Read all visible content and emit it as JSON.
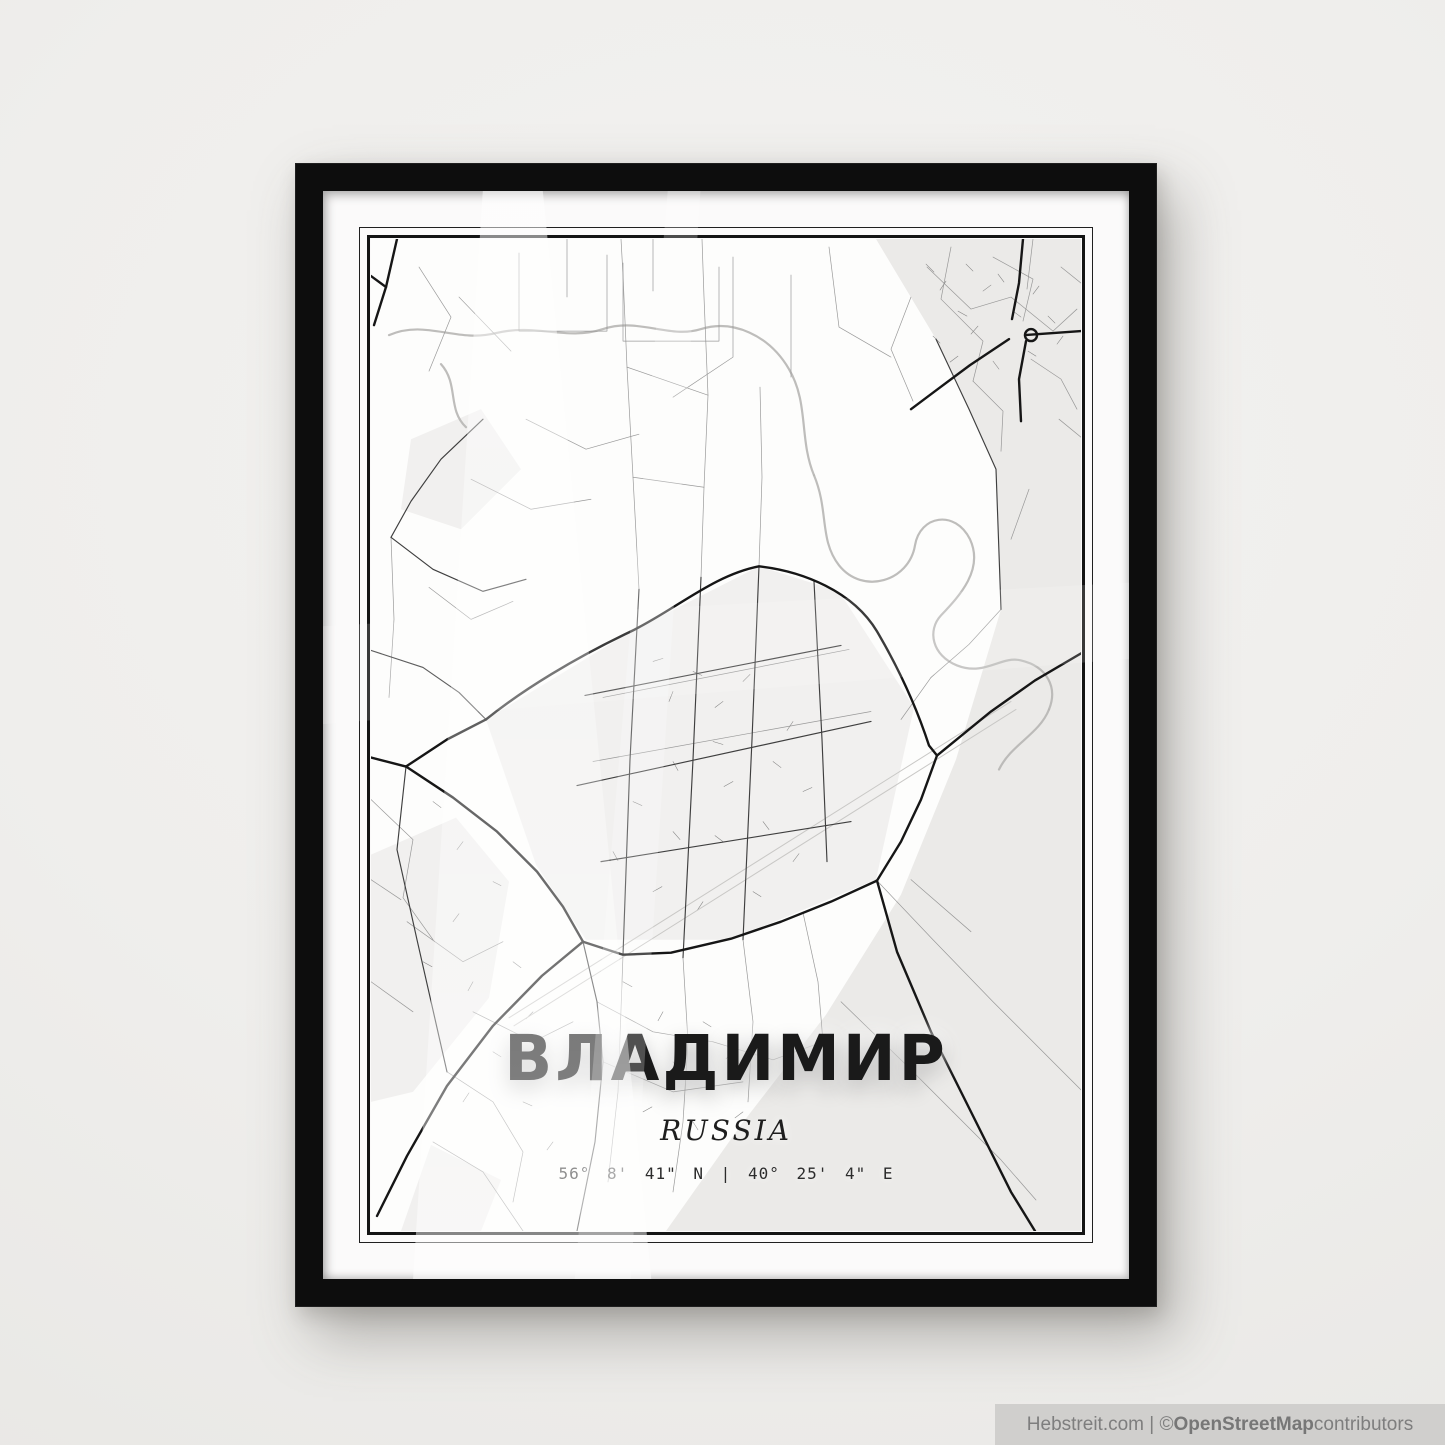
{
  "scene": {
    "wall_color": "#efeeec",
    "frame_color": "#0d0d0d",
    "mat_color": "#fbfafa",
    "map_background": "#fdfdfc"
  },
  "poster": {
    "title": "ВЛАДИМИР",
    "subtitle": "RUSSIA",
    "coordinates": "56° 8' 41\" N | 40° 25' 4\" E"
  },
  "watermark": {
    "prefix": "Hebstreit.com | © ",
    "brand": "OpenStreetMap",
    "suffix": " contributors"
  },
  "map": {
    "viewBox": "0 0 710 991",
    "layers": [
      {
        "name": "tinted-areas",
        "fill": "#ebeae8",
        "paths": [
          "M505,0 L710,0 L710,991 L295,991 L370,885 L455,775 L530,655 L585,520 L630,370 L625,230 L565,100 Z"
        ]
      },
      {
        "name": "tinted-areas-light",
        "fill": "#f1f0ef",
        "paths": [
          "M115,480 L260,392 L388,327 L468,352 L543,468 L505,640 L360,700 L215,700 L165,625 Z",
          "M0,615 L85,578 L138,642 L118,758 L42,852 L0,862 Z",
          "M60,905 L130,940 L110,991 L30,991 Z",
          "M40,200 L110,170 L150,230 L90,290 L30,270 Z"
        ]
      },
      {
        "name": "hatch-texture",
        "stroke": "#6f6f6f",
        "width": 0.55,
        "opacity": 0.85,
        "paths": [
          "M555,25 l8,8 M575,42 l-6,9 M595,25 l7,7 M612,52 l8,-6 M627,35 l6,8 M587,72 l9,5 M607,87 l-7,8 M642,72 l8,6 M662,55 l6,-8 M677,77 l7,7 M692,97 l-6,8 M657,112 l8,5 M622,122 l6,8 M587,117 l-8,6 M562,97 l7,7",
          "M282,422 l10,-3 M302,452 l-4,10 M322,432 l9,4 M352,462 l-8,6 M372,442 l7,-7 M342,502 l10,3 M302,522 l5,9 M362,542 l-9,5 M402,522 l8,6 M422,482 l-6,9 M432,552 l9,-4 M392,582 l6,8 M352,602 l-8,-6 M302,592 l7,8 M262,562 l9,4 M242,612 l5,9 M282,652 l9,-5 M332,662 l-6,9 M382,652 l8,5 M422,622 l6,-8",
          "M62,562 l8,6 M92,602 l-6,8 M122,642 l8,4 M82,682 l6,-8 M52,722 l9,5 M102,742 l-5,9 M142,722 l8,6 M162,772 l-7,7 M122,812 l8,5 M92,862 l6,-9 M152,862 l9,4 M182,902 l-6,8",
          "M252,742 l9,5 M292,772 l-5,9 M332,782 l8,5 M362,812 l-7,7 M302,822 l6,9 M272,872 l9,-5 M322,882 l5,8 M372,872 l-8,6"
        ]
      },
      {
        "name": "water",
        "stroke": "#b7b6b4",
        "width": 2.2,
        "opacity": 0.9,
        "paths": [
          "M18,96 C55,80 85,104 125,94 C165,84 195,102 232,90 C268,78 298,100 330,90 C362,80 398,96 418,130 C438,164 428,200 443,236",
          "M443,236 C458,272 448,300 468,326 C492,356 538,342 544,306 C549,276 584,270 599,300 C613,330 589,356 570,376 C556,391 561,416 586,426 C614,437 630,416 650,421 C676,427 687,448 678,470",
          "M678,470 C668,495 640,505 628,530",
          "M70,125 C88,145 76,170 95,188"
        ]
      },
      {
        "name": "railway",
        "stroke": "#c9c8c6",
        "width": 1,
        "paths": [
          "M138,778 L640,462",
          "M143,786 L645,470"
        ]
      },
      {
        "name": "roads-minor",
        "stroke": "#8f8f8f",
        "width": 0.7,
        "opacity": 0.9,
        "paths": [
          "M148,14 L148,92 L236,92 L236,16",
          "M252,24 L252,102 L348,102 L348,28",
          "M196,0 L196,58",
          "M282,0 L282,52",
          "M88,58 L140,112",
          "M48,28 L80,78 L58,132",
          "M362,18 L362,118 L302,158",
          "M420,36 L420,138",
          "M458,8 L468,88 L520,118",
          "M268,350 L262,238 L256,128 L252,36 L250,0",
          "M330,338 L333,248 L337,156 L333,58 L331,0",
          "M388,327 L391,238 L389,148",
          "M256,128 L337,156",
          "M262,238 L333,248",
          "M155,180 L215,210 L268,195",
          "M100,240 L160,270 L220,260",
          "M556,28 L600,70 L640,58 L682,92 L706,70",
          "M580,8 L570,60 L612,102 L602,142",
          "M622,18 L662,40 L652,82",
          "M662,0 L656,50",
          "M690,28 L710,44",
          "M602,142 L632,172 L630,212",
          "M540,58 L520,110 L542,162",
          "M660,120 L690,140 L706,170",
          "M630,370 L598,405 L560,438",
          "M658,250 L640,300",
          "M688,180 L710,198",
          "M560,438 L530,480",
          "M20,298 L23,380 L18,458",
          "M58,348 L100,380 L142,362",
          "M0,560 L42,600 L32,658 L62,700",
          "M76,832 L122,862 L152,912 L142,962",
          "M36,682 L92,722 L132,702",
          "M102,772 L162,802 L202,782",
          "M62,902 L112,932 L152,991",
          "M0,742 L42,772",
          "M0,640 L30,660",
          "M226,762 L282,792 L342,802",
          "M232,822 L302,852 L372,842",
          "M252,715 L247,852 L237,942",
          "M312,718 L317,802 L312,882 L302,952",
          "M372,700 L382,782 L377,862",
          "M432,673 L447,742 L452,802",
          "M342,802 L402,820 L452,802",
          "M505,640 L562,700 L622,762 L682,822 L710,850",
          "M540,640 L600,692",
          "M470,762 L532,822 L582,872",
          "M582,872 L630,920 L665,960",
          "M232,458 L478,410",
          "M222,522 L500,472"
        ]
      },
      {
        "name": "roads-medium",
        "stroke": "#3f3f3f",
        "width": 1.15,
        "paths": [
          "M268,350 L259,520 L252,715",
          "M330,338 L322,520 L312,718",
          "M388,327 L381,500 L372,700",
          "M443,342 L451,500 L456,622",
          "M214,456 L470,406",
          "M206,546 L500,482",
          "M230,622 L480,582",
          "M565,100 L598,170 L625,230 L630,370",
          "M35,527 L26,610 L46,700 L76,832",
          "M212,702 L226,762 L232,822 L224,902 L206,991",
          "M0,411 L52,428 L88,453 L115,480",
          "M112,180 L70,220 L40,262 L20,298",
          "M20,298 L62,330 L112,352 L155,340"
        ]
      },
      {
        "name": "roads-major",
        "stroke": "#161616",
        "width": 2.4,
        "paths": [
          "M115,480 C152,450 205,418 260,392 C305,370 342,336 388,327 C432,332 482,352 506,392 C526,426 545,466 558,506 L566,516",
          "M710,414 L664,441 L620,472 L566,516",
          "M566,516 L550,560 L530,602 L506,641",
          "M506,641 L460,662 L410,682 L360,699 L300,713 L252,715 L212,702",
          "M35,527 L82,558 L126,592 L166,632 L192,667 L212,702",
          "M35,527 L0,518",
          "M35,527 L76,500 L115,480",
          "M26,0 L15,48 L3,86",
          "M15,48 L0,37",
          "M652,0 L648,44 L641,80",
          "M660,96 m-6,0 a6,6 0 1,0 12,0 a6,6 0 1,0 -12,0",
          "M654,96 L710,92",
          "M655,102 L648,140 L650,182",
          "M638,100 L599,126 L564,152 L540,170",
          "M506,641 L526,712 L560,792 L600,872 L640,952 L664,991",
          "M212,702 L171,736 L122,786 L76,846 L36,916 L6,976"
        ]
      }
    ]
  }
}
